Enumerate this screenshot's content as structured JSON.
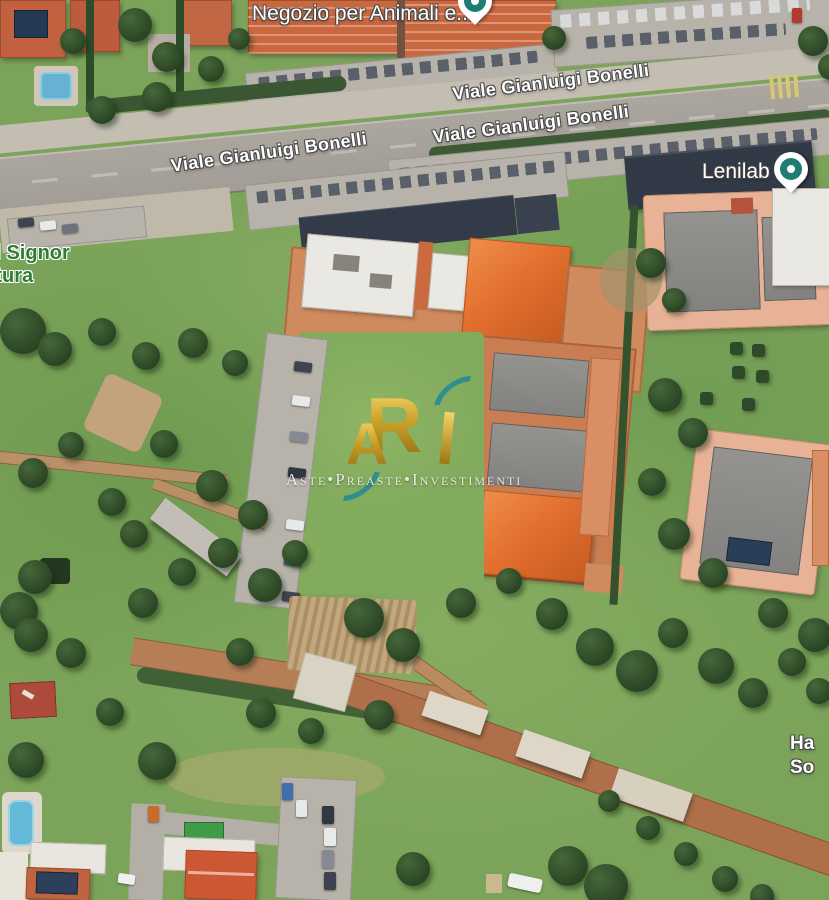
{
  "map": {
    "view_type": "satellite",
    "street_labels": [
      {
        "text": "Viale Gianluigi Bonelli"
      },
      {
        "text": "Viale Gianluigi Bonelli"
      },
      {
        "text": "Viale Gianluigi Bonelli"
      }
    ],
    "poi": {
      "negozio": {
        "text": "Negozio per Animali e...",
        "pin_color": "#217c74"
      },
      "lenilab": {
        "text": "Lenilab",
        "pin_color": "#217c74"
      },
      "church": {
        "line1": "del Signor",
        "line2": "entura",
        "color": "#2f7d35"
      },
      "edge": {
        "line1": "Ha",
        "line2": "So"
      }
    }
  },
  "watermark": {
    "monogram": {
      "r": "R",
      "a": "A"
    },
    "tagline": "Aste•Preaste•Investimenti",
    "gold": "#caa128",
    "teal": "#2f8f8c"
  }
}
